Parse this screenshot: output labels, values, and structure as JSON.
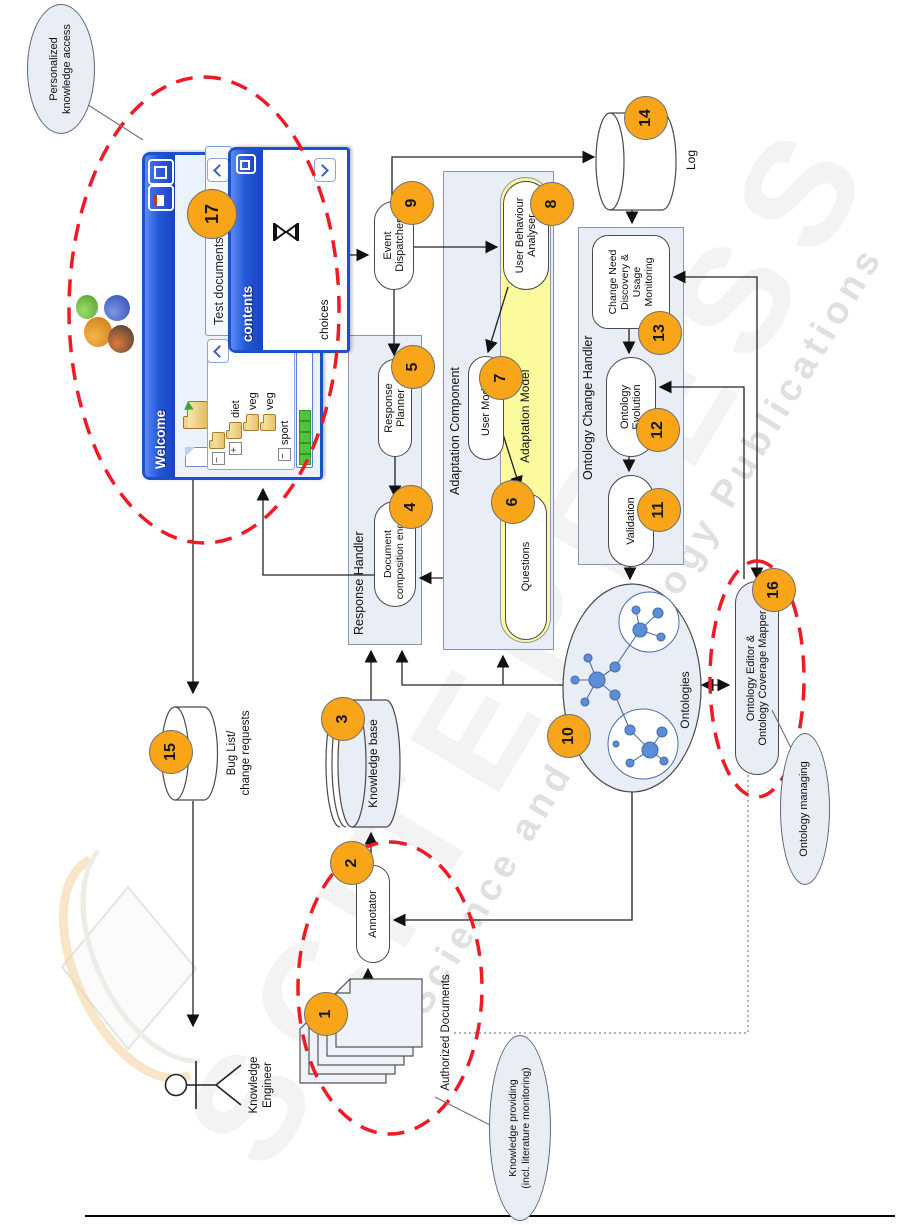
{
  "watermark": {
    "big": "SCITEPRESS",
    "sub": "Science and Technology Publications"
  },
  "diagram": {
    "actor": {
      "line1": "Knowledge",
      "line2": "Engineer"
    },
    "containers": {
      "response_handler": "Response Handler",
      "adaptation_component": "Adaptation Component",
      "adaptation_model": "Adaptation Model",
      "ontology_change_handler": "Ontology Change Handler"
    },
    "nodes": {
      "authorized_documents": {
        "num": "1",
        "label": "Authorized Documents"
      },
      "annotator": {
        "num": "2",
        "label": "Annotator"
      },
      "knowledge_base": {
        "num": "3",
        "label": "Knowledge base"
      },
      "document_composition_engine": {
        "num": "4",
        "line1": "Document",
        "line2": "composition engine"
      },
      "response_planner": {
        "num": "5",
        "line1": "Response",
        "line2": "Planner"
      },
      "questions": {
        "num": "6",
        "label": "Questions"
      },
      "user_model": {
        "num": "7",
        "label": "User Model"
      },
      "user_behaviour_analyser": {
        "num": "8",
        "line1": "User Behaviour",
        "line2": "Analyser"
      },
      "event_dispatcher": {
        "num": "9",
        "line1": "Event",
        "line2": "Dispatcher"
      },
      "ontologies": {
        "num": "10",
        "label": "Ontologies"
      },
      "validation": {
        "num": "11",
        "label": "Validation"
      },
      "ontology_evolution": {
        "num": "12",
        "line1": "Ontology",
        "line2": "Evolution"
      },
      "change_need": {
        "num": "13",
        "line1": "Change Need",
        "line2": "Discovery &",
        "line3": "Usage",
        "line4": "Monitoring"
      },
      "log": {
        "num": "14",
        "label": "Log"
      },
      "bug_list": {
        "num": "15",
        "line1": "Bug List/",
        "line2": "change requests"
      },
      "ontology_editor": {
        "num": "16",
        "line1": "Ontology Editor &",
        "line2": "Ontology Coverage Mapper"
      },
      "ui_window": {
        "num": "17"
      }
    },
    "callouts": {
      "personalized": {
        "line1": "Personalized",
        "line2": "knowledge access"
      },
      "knowledge_providing": {
        "line1": "Knowledge providing",
        "line2": "(incl. literature monitoring)"
      },
      "ontology_managing": {
        "label": "Ontology managing"
      }
    }
  },
  "app_window": {
    "window1": {
      "title": "Welcome",
      "taskpane_label": "Test documents",
      "tree": {
        "item1": "diet",
        "item2": "veg",
        "item3": "veg",
        "item4": "sport"
      }
    },
    "window2": {
      "title": "contents",
      "footer_label": "choices"
    }
  },
  "colors": {
    "badge_orange": "#F9A51A",
    "annotation_red": "#ED1C24",
    "container_fill": "#E9EDF6",
    "adaptation_model_yellow": "#FBFA9C",
    "xp_title_blue": "#2458D8",
    "graph_node_blue": "#5B8DD9"
  }
}
